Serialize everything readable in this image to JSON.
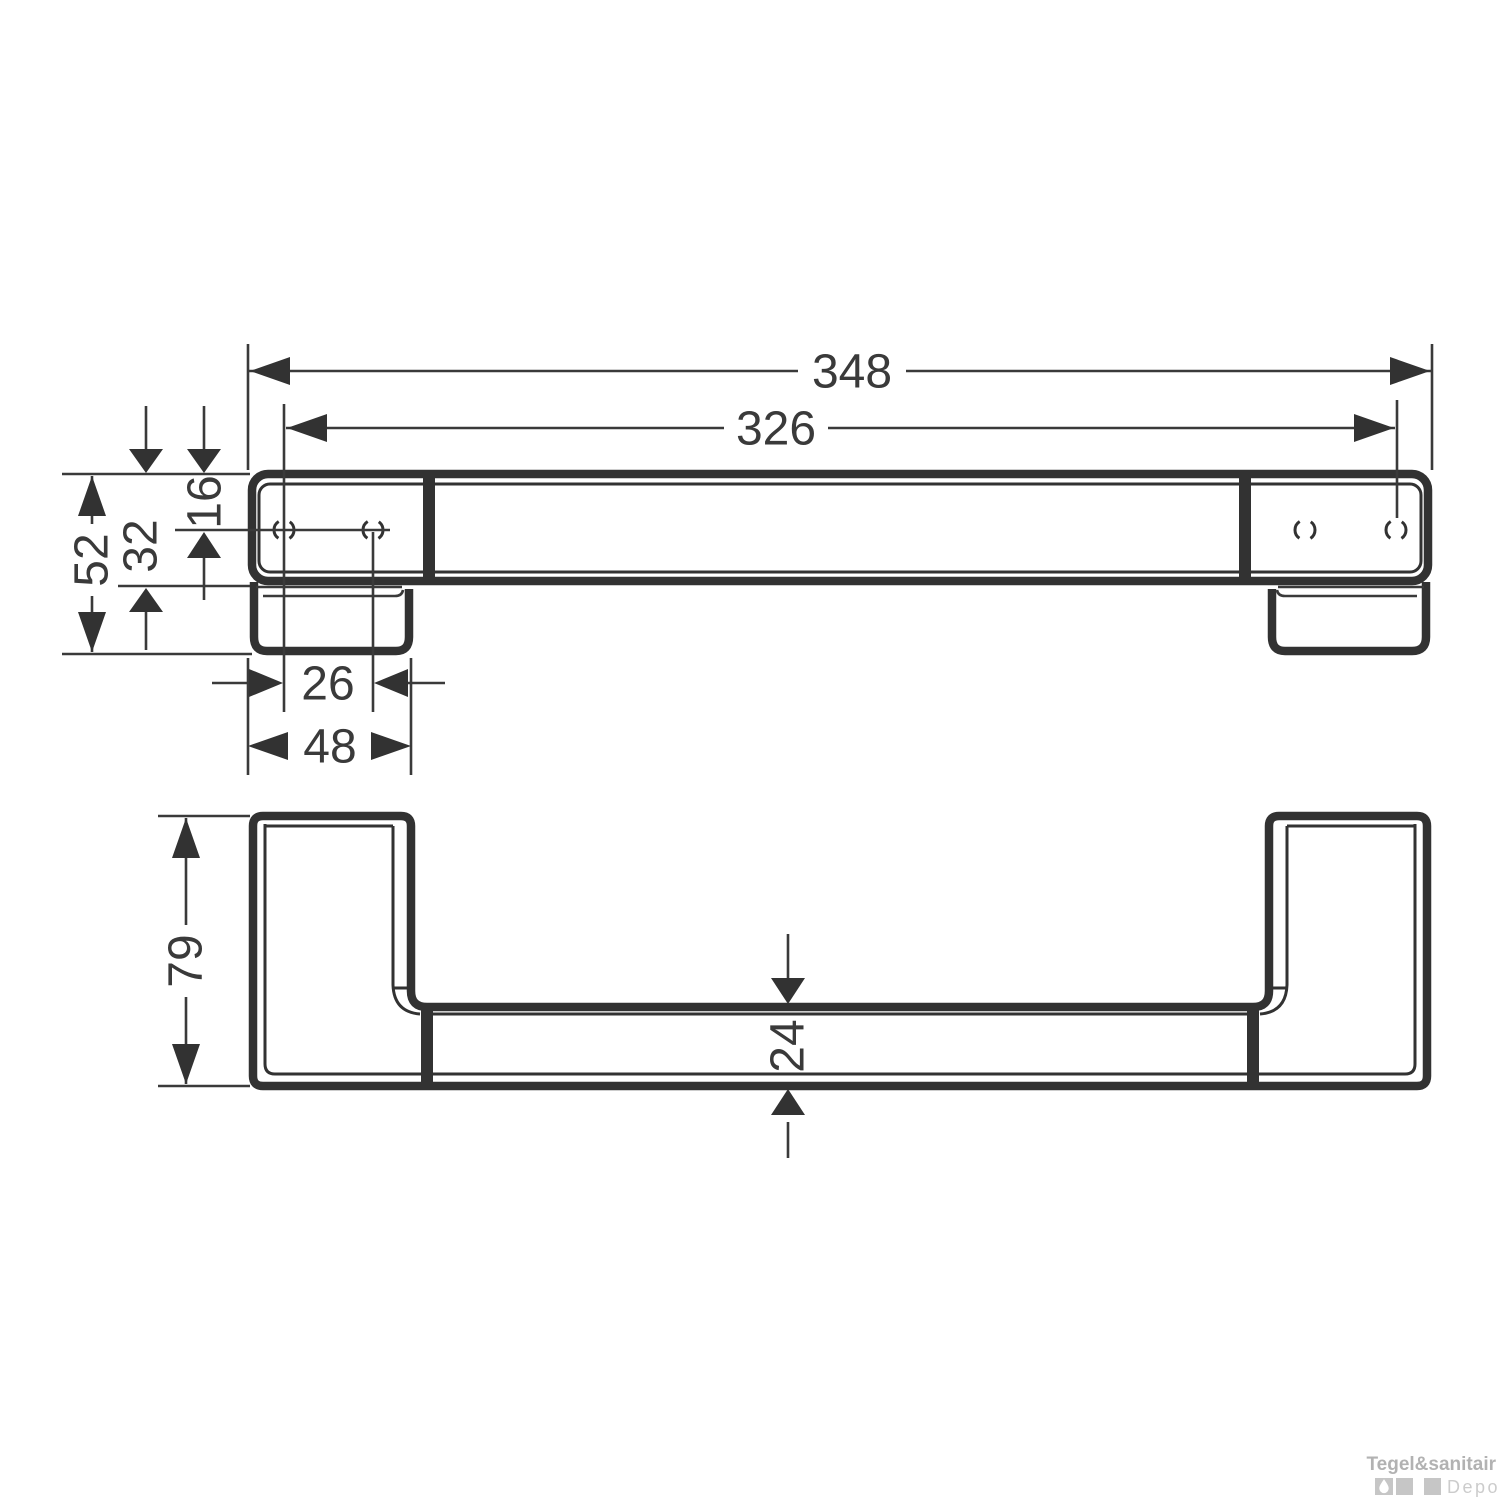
{
  "diagram": {
    "description": "Technical dimension drawing of a wall-mounted grab bar, front view and profile view",
    "line_color": "#323232",
    "front_view": {
      "dim_total_length": "348",
      "dim_hole_span": "326",
      "dim_end_height": "52",
      "dim_bar_height": "32",
      "dim_hole_top_offset": "16",
      "dim_hole_pitch": "26",
      "dim_end_width": "48"
    },
    "profile_view": {
      "dim_depth": "79",
      "dim_bar_depth": "24"
    }
  },
  "watermark": {
    "brand": "Tegel&sanitair",
    "suffix": "Depot",
    "brand_color": "#b2b2b2",
    "square_color": "#c6c6c6",
    "suffix_color": "#cccccc",
    "icon": "water-drop-icon"
  }
}
